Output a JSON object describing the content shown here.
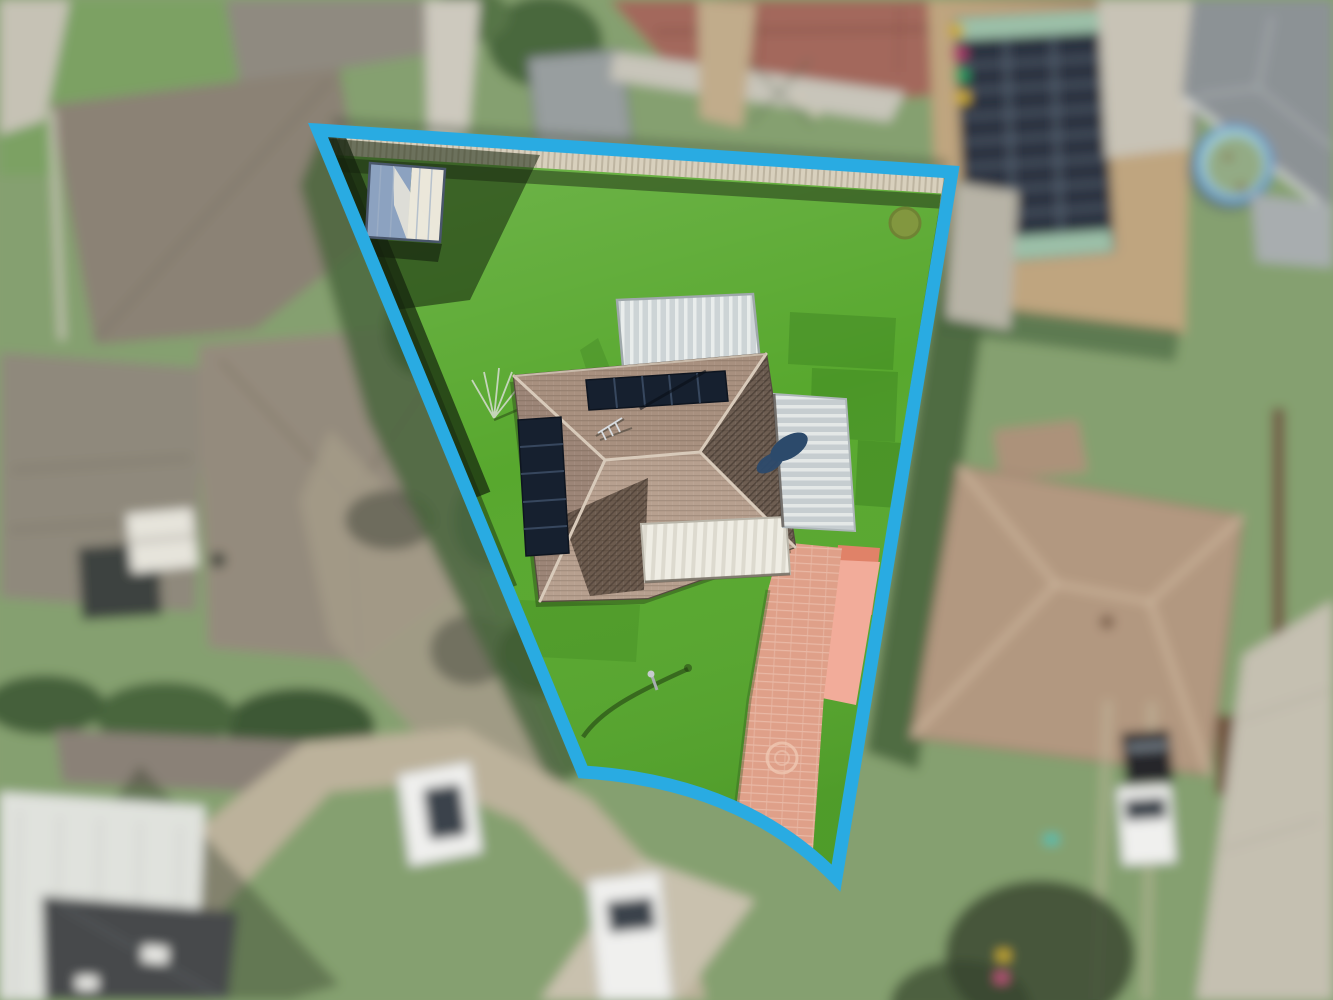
{
  "scene": {
    "type": "aerial-drone-photograph",
    "subject": "Suburban residential property with its lot boundary highlighted in blue",
    "boundary_shape": "Wedge-shaped lot: wide straight rear boundary at top, splayed straight sides, concave curved street frontage at bottom",
    "property_features": [
      "bright green mowed lawn",
      "single-storey house with brown tiled hip roof",
      "two dark rooftop solar panel arrays",
      "satellite dish on roof",
      "white ribbed pergola roof",
      "grey metal carport roof",
      "white garage door",
      "terracotta brick paved driveway with circle motif",
      "garden shed with half-shaded gable roof",
      "rotary clothesline",
      "dirt patch in lawn",
      "street light pole with curved shadow"
    ],
    "surroundings_features": [
      "blurred neighbouring houses and roofs",
      "neighbour shed roof covered in solar panels",
      "round above-ground swimming pool",
      "red corrugated roof",
      "tan hip roof neighbour house",
      "wheelie bins",
      "parked white cars and utes",
      "parked black car",
      "paved footpath along curved street",
      "hedges, trees and fence shadows"
    ]
  },
  "colors": {
    "boundary": "#29ABE2",
    "lawn": "#58A82E",
    "fence": "#D8D0BD",
    "shed_roof_blue": "#8CA2C0",
    "shed_roof_white": "#EBE7DA",
    "roof_top": "#A8907F",
    "roof_left": "#9C8577",
    "roof_bottom": "#B7A08F",
    "roof_shaded": "#6E5E52",
    "roof_valley": "#655549",
    "roof_ridge": "#D8CABA",
    "solar_panel": "#16202F",
    "satellite_dish": "#2C4A6B",
    "driveway_pad": "#F2AC9A",
    "driveway_red": "#E08268",
    "driveway": "#DFA089",
    "dirt_patch": "#82973F",
    "outside_lawn": "#85A06F",
    "red_roof": "#A3675B",
    "grey_roof": "#8C9295",
    "brown_grey_roof": "#8B8275",
    "tan_ground": "#BFA57F",
    "solar_shed_dark": "#3A4149",
    "solar_shed_panels": "#2A3340",
    "solar_shed_trim": "#9CC0A8",
    "pool_ring": "#6C9CC6",
    "pool_rim": "#A7D5DB",
    "pool_water": "#93AB85",
    "neighbor_roof": "#B29880",
    "neighbor_ridge": "#D6C0A6",
    "concrete": "#C5C0B1",
    "paver_path": "#BFB59E",
    "white_roof": "#E0E2DD",
    "charcoal_roof": "#46494C",
    "vehicle_white": "#F0F0EE",
    "vehicle_dark": "#25272A",
    "window_glass": "#3A424C",
    "hedge": "#4A663D"
  }
}
